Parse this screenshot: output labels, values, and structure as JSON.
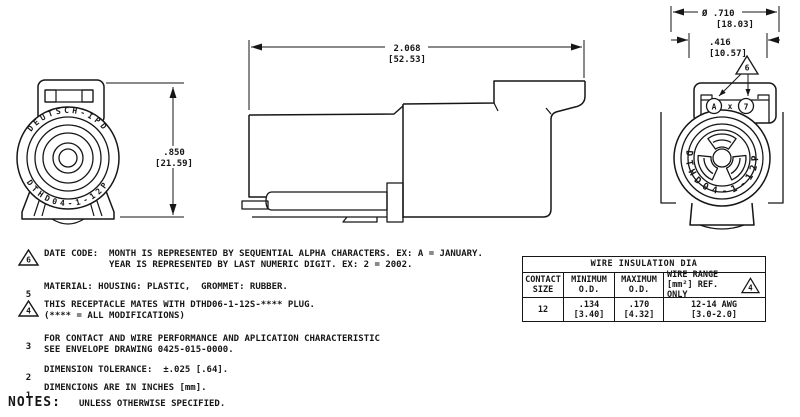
{
  "drawing": {
    "front_view": {
      "brand_arc": "DEUTSCH-IPD",
      "part_arc": "DTHD04-1-12P",
      "height_in": ".850",
      "height_mm": "[21.59]"
    },
    "side_view": {
      "length_in": "2.068",
      "length_mm": "[52.53]"
    },
    "rear_view": {
      "dia_in": "Ø .710",
      "dia_mm": "[18.03]",
      "width_in": ".416",
      "width_mm": "[10.57]",
      "flag": "6",
      "date_month": "A",
      "date_sep": "x",
      "date_year": "7",
      "part_arc": "DTHD04-1-12P"
    }
  },
  "notes": {
    "header": "NOTES:",
    "header_suffix": "UNLESS OTHERWISE SPECIFIED.",
    "items": [
      {
        "num": "6",
        "line1": "DATE CODE:  MONTH IS REPRESENTED BY SEQUENTIAL ALPHA CHARACTERS. EX: A = JANUARY.",
        "line2": "YEAR IS REPRESENTED BY LAST NUMERIC DIGIT. EX: 2 = 2002."
      },
      {
        "num": "5",
        "line1": "MATERIAL: HOUSING: PLASTIC,  GROMMET: RUBBER."
      },
      {
        "num": "4",
        "line1": "THIS RECEPTACLE MATES WITH DTHD06-1-12S-**** PLUG.",
        "line2": "(**** = ALL MODIFICATIONS)"
      },
      {
        "num": "3",
        "line1": "FOR CONTACT AND WIRE PERFORMANCE AND APLICATION CHARACTERISTIC",
        "line2": "SEE ENVELOPE DRAWING 0425-015-0000."
      },
      {
        "num": "2",
        "line1": "DIMENSION TOLERANCE:  ±.025 [.64]."
      },
      {
        "num": "1",
        "line1": "DIMENCIONS ARE IN INCHES [mm]."
      }
    ]
  },
  "table": {
    "title": "WIRE INSULATION DIA",
    "flag": "4",
    "headers": [
      {
        "l1": "CONTACT",
        "l2": "SIZE"
      },
      {
        "l1": "MINIMUM",
        "l2": "O.D."
      },
      {
        "l1": "MAXIMUM",
        "l2": "O.D."
      },
      {
        "l1": "WIRE RANGE",
        "l2": "[mm²] REF. ONLY"
      }
    ],
    "row": [
      {
        "l1": "12",
        "l2": ""
      },
      {
        "l1": ".134",
        "l2": "[3.40]"
      },
      {
        "l1": ".170",
        "l2": "[4.32]"
      },
      {
        "l1": "12-14 AWG",
        "l2": "[3.0-2.0]"
      }
    ]
  },
  "colors": {
    "ink": "#161616",
    "paper": "#ffffff"
  }
}
